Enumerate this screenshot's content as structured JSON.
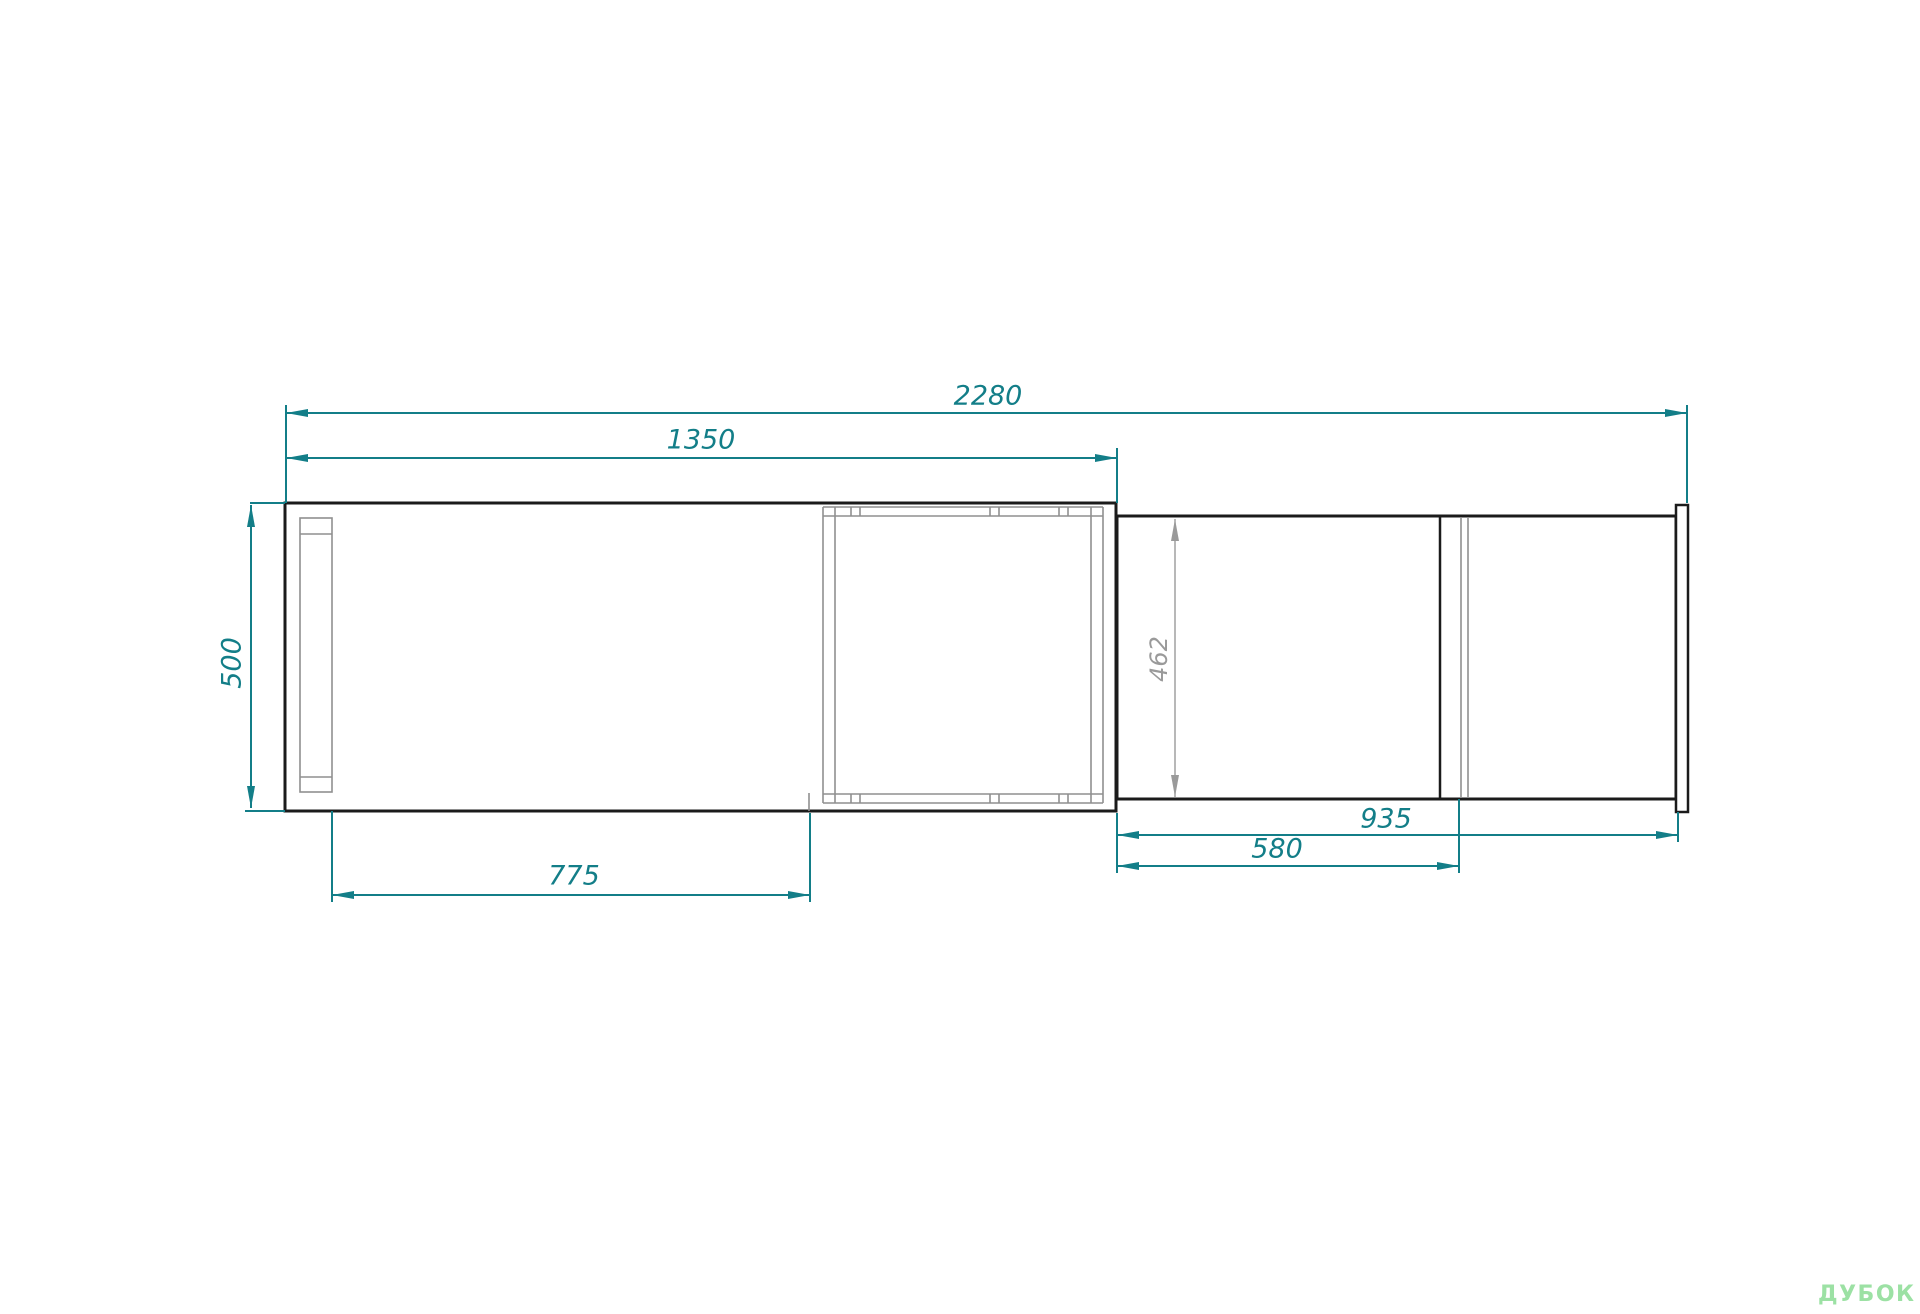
{
  "drawing": {
    "dimension_labels": {
      "total_width": "2280",
      "left_section_width": "1350",
      "left_section_depth": "500",
      "left_inner_width": "775",
      "right_section_depth": "462",
      "right_section_width": "935",
      "right_inner_width": "580"
    }
  },
  "watermark": {
    "brand": "ДУБОК"
  },
  "colors": {
    "dimension_teal": "#137e88",
    "detail_gray": "#8f8f8f",
    "outline_black": "#1b1b1b",
    "watermark_green": "#9ce1a4",
    "background": "#ffffff"
  }
}
